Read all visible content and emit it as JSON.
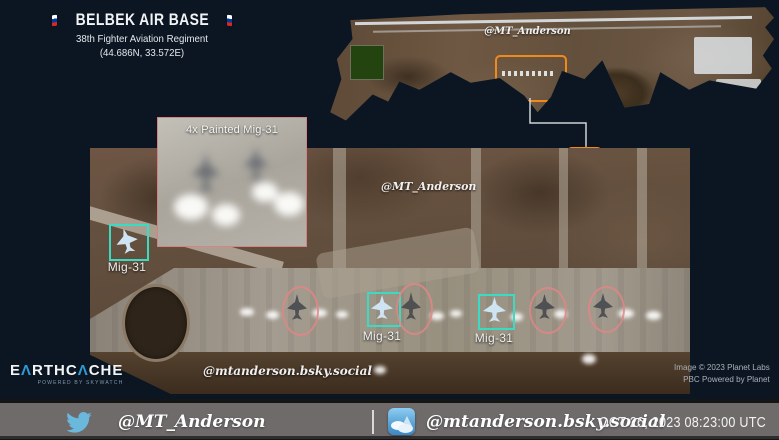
{
  "header": {
    "title": "BELBEK AIR BASE",
    "subtitle": "38th Fighter Aviation Regiment",
    "coordinates": "(44.686N, 33.572E)"
  },
  "overview": {
    "watermark": "@MT_Anderson",
    "callout_label": "C"
  },
  "inset": {
    "label": "4x Painted Mig-31"
  },
  "main_image": {
    "watermark_top": "@MT_Anderson",
    "watermark_bottom": "@mtanderson.bsky.social",
    "labels": [
      "Mig-31",
      "Mig-31",
      "Mig-31"
    ]
  },
  "branding": {
    "logo_p1": "E",
    "logo_a": "Λ",
    "logo_p2": "RTHC",
    "logo_p3": "CHE",
    "logo_tagline": "POWERED BY SKYWATCH"
  },
  "credits": {
    "line1": "Image © 2023 Planet Labs",
    "line2": "PBC Powered by Planet"
  },
  "footer": {
    "twitter_handle": "@MT_Anderson",
    "bluesky_handle": "@mtanderson.bsky.social",
    "timestamp": "OCT 26, 2023 08:23:00 UTC"
  },
  "colors": {
    "background": "#0c1622",
    "accent_orange": "#f08a1d",
    "annotation_cyan": "#3cd9c3",
    "annotation_pink": "#dd8686",
    "footer_gray": "#6f6b6b",
    "twitter_blue": "#6bb8dd",
    "bluesky_blue": "#3a86c8"
  }
}
